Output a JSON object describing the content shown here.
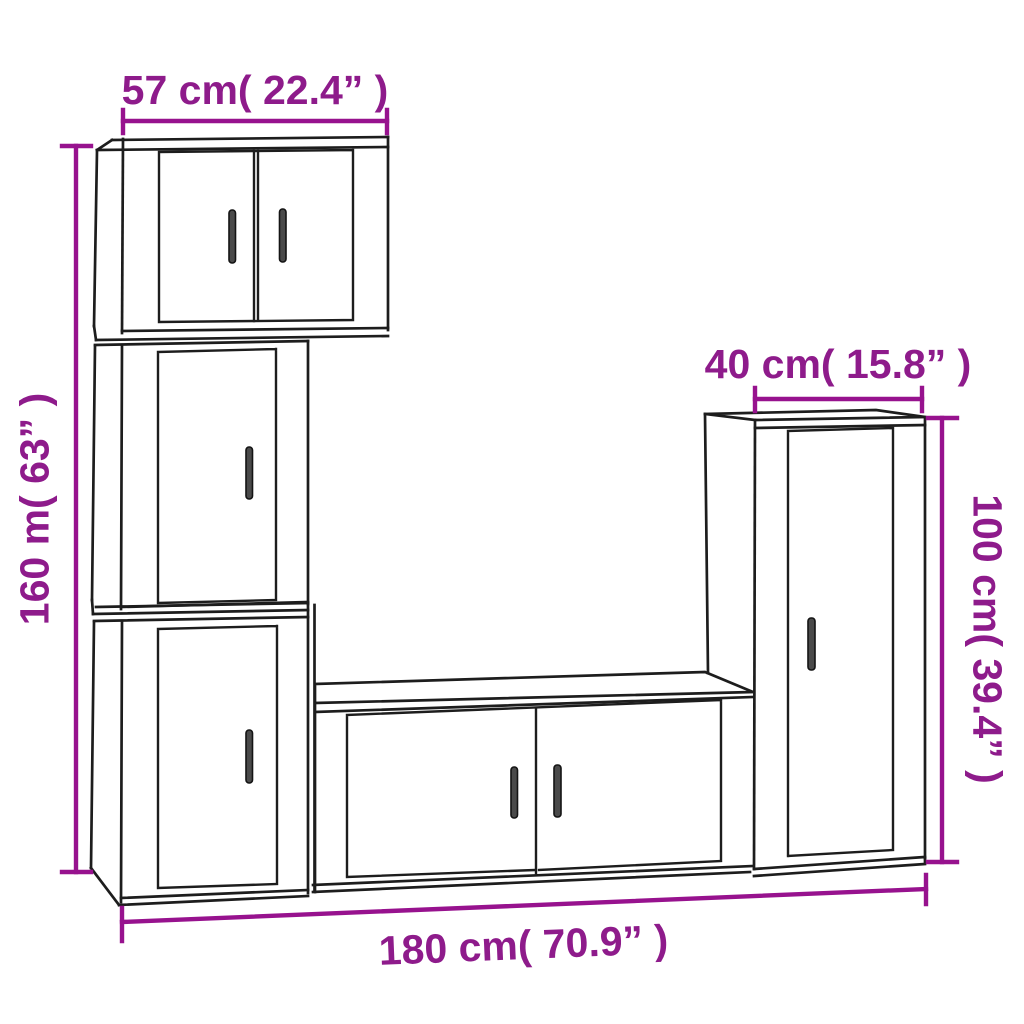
{
  "diagram": {
    "background_color": "#ffffff",
    "outline_color": "#1d1d1d",
    "dimension_color": "#97128E",
    "handle_color": "#4a4a4a",
    "dimensions": {
      "top_width": {
        "label": "57 cm( 22.4” )",
        "value_cm": 57,
        "value_inch": 22.4
      },
      "left_height": {
        "label": "160 m( 63” )",
        "value_cm": 160,
        "value_inch": 63
      },
      "right_depth": {
        "label": "40 cm( 15.8” )",
        "value_cm": 40,
        "value_inch": 15.8
      },
      "right_height": {
        "label": "100 cm( 39.4” )",
        "value_cm": 100,
        "value_inch": 39.4
      },
      "bottom_width": {
        "label": "180 cm( 70.9” )",
        "value_cm": 180,
        "value_inch": 70.9
      }
    },
    "cabinets": [
      {
        "name": "wall-cabinet-two-door-top-left",
        "doors": 2,
        "handles": 2
      },
      {
        "name": "wall-cabinet-one-door-middle-left",
        "doors": 1,
        "handles": 1
      },
      {
        "name": "wall-cabinet-one-door-bottom-left",
        "doors": 1,
        "handles": 1
      },
      {
        "name": "tv-stand-two-door-center",
        "doors": 2,
        "handles": 2
      },
      {
        "name": "tall-cabinet-one-door-right",
        "doors": 1,
        "handles": 1
      }
    ]
  }
}
